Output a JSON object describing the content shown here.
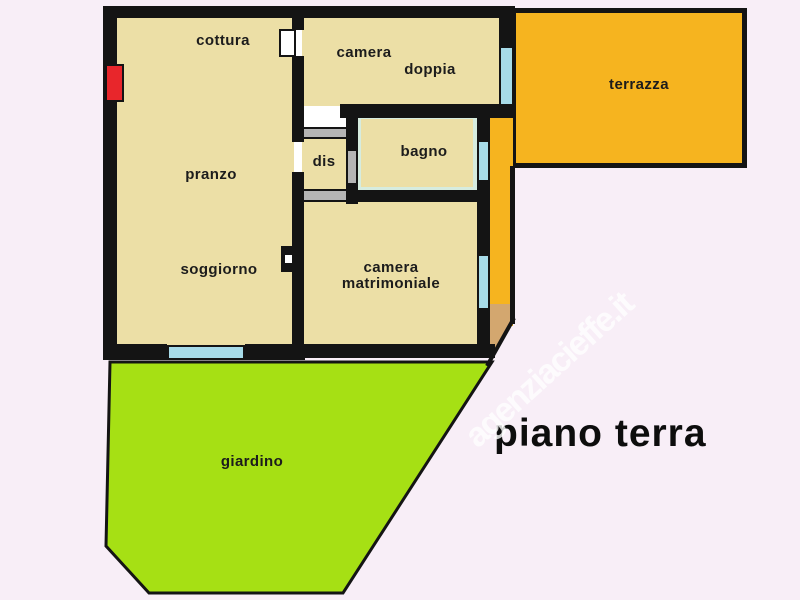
{
  "plan": {
    "title": "piano terra",
    "watermark": "agenziacieffe.it",
    "labels": {
      "cottura": "cottura",
      "camera_doppia_1": "camera",
      "camera_doppia_2": "doppia",
      "pranzo": "pranzo",
      "dis": "dis",
      "bagno": "bagno",
      "soggiorno": "soggiorno",
      "camera_matrimoniale_1": "camera",
      "camera_matrimoniale_2": "matrimoniale",
      "terrazza": "terrazza",
      "giardino": "giardino"
    },
    "colors": {
      "background": "#f8eef7",
      "room_fill": "#ecdfa6",
      "terrace": "#f6b41f",
      "garden": "#a6e014",
      "window": "#a7dbe8",
      "wall": "#141414",
      "door_red": "#e8262b",
      "landing_tan": "#d3a76f",
      "bath_tile": "#d6ecdf",
      "lintel_gray": "#b5b5b5",
      "watermark_color": "#ffffff",
      "title_color": "#0d0d0d"
    }
  }
}
